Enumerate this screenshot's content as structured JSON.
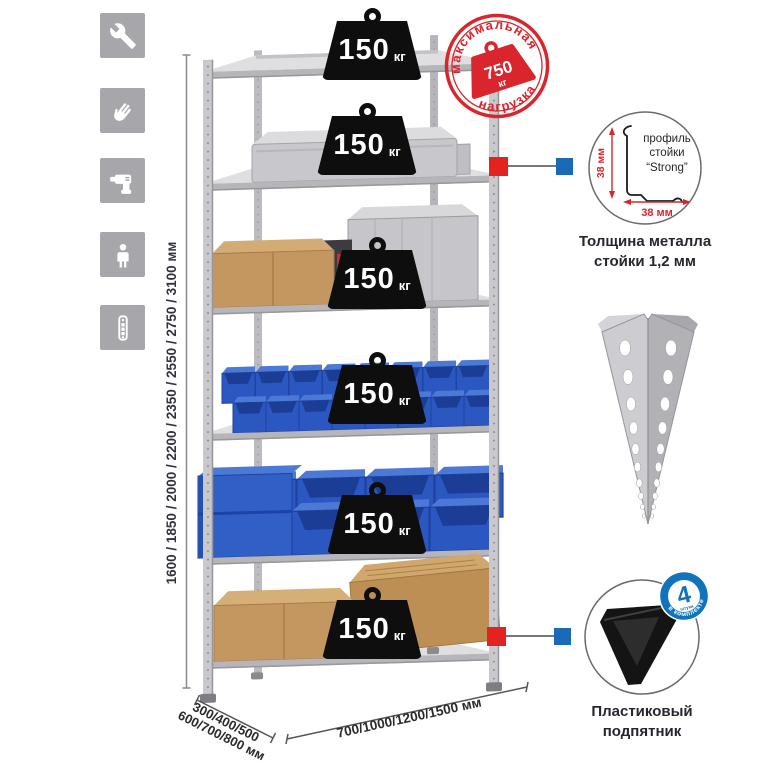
{
  "sidebar": {
    "icons": [
      {
        "name": "wrench-icon"
      },
      {
        "name": "gloves-icon"
      },
      {
        "name": "drill-icon"
      },
      {
        "name": "person-icon"
      },
      {
        "name": "perforated-profile-icon"
      }
    ]
  },
  "rack": {
    "weights": [
      {
        "value": "150",
        "unit": "кг"
      },
      {
        "value": "150",
        "unit": "кг"
      },
      {
        "value": "150",
        "unit": "кг"
      },
      {
        "value": "150",
        "unit": "кг"
      },
      {
        "value": "150",
        "unit": "кг"
      },
      {
        "value": "150",
        "unit": "кг"
      }
    ]
  },
  "stamp": {
    "arc_top": "максимальная",
    "arc_bottom": "нагрузка",
    "value": "750",
    "unit": "кг"
  },
  "dimensions": {
    "height": "1600 / 1850 / 2000 / 2200 / 2350 / 2550 / 2750 / 3100 мм",
    "depth_line1": "300/400/500",
    "depth_line2": "600/700/800 мм",
    "width": "700/1000/1200/1500 мм"
  },
  "profile_detail": {
    "label_line1": "профиль",
    "label_line2": "стойки",
    "label_line3": "“Strong”",
    "dim_vertical": "38 мм",
    "dim_horizontal": "38 мм",
    "caption_line1": "Толщина металла",
    "caption_line2": "стойки 1,2 мм"
  },
  "foot_detail": {
    "badge_value": "4",
    "badge_sub": "штуки",
    "badge_ring": "в комплекте",
    "caption_line1": "Пластиковый",
    "caption_line2": "подпятник"
  },
  "colors": {
    "accent_red": "#d9262c",
    "accent_blue": "#1b6ab5",
    "bin_blue": "#2b57c0",
    "metal_gray": "#c6c6ca",
    "cardboard": "#c59760",
    "tile_gray": "#a7a7ab"
  }
}
